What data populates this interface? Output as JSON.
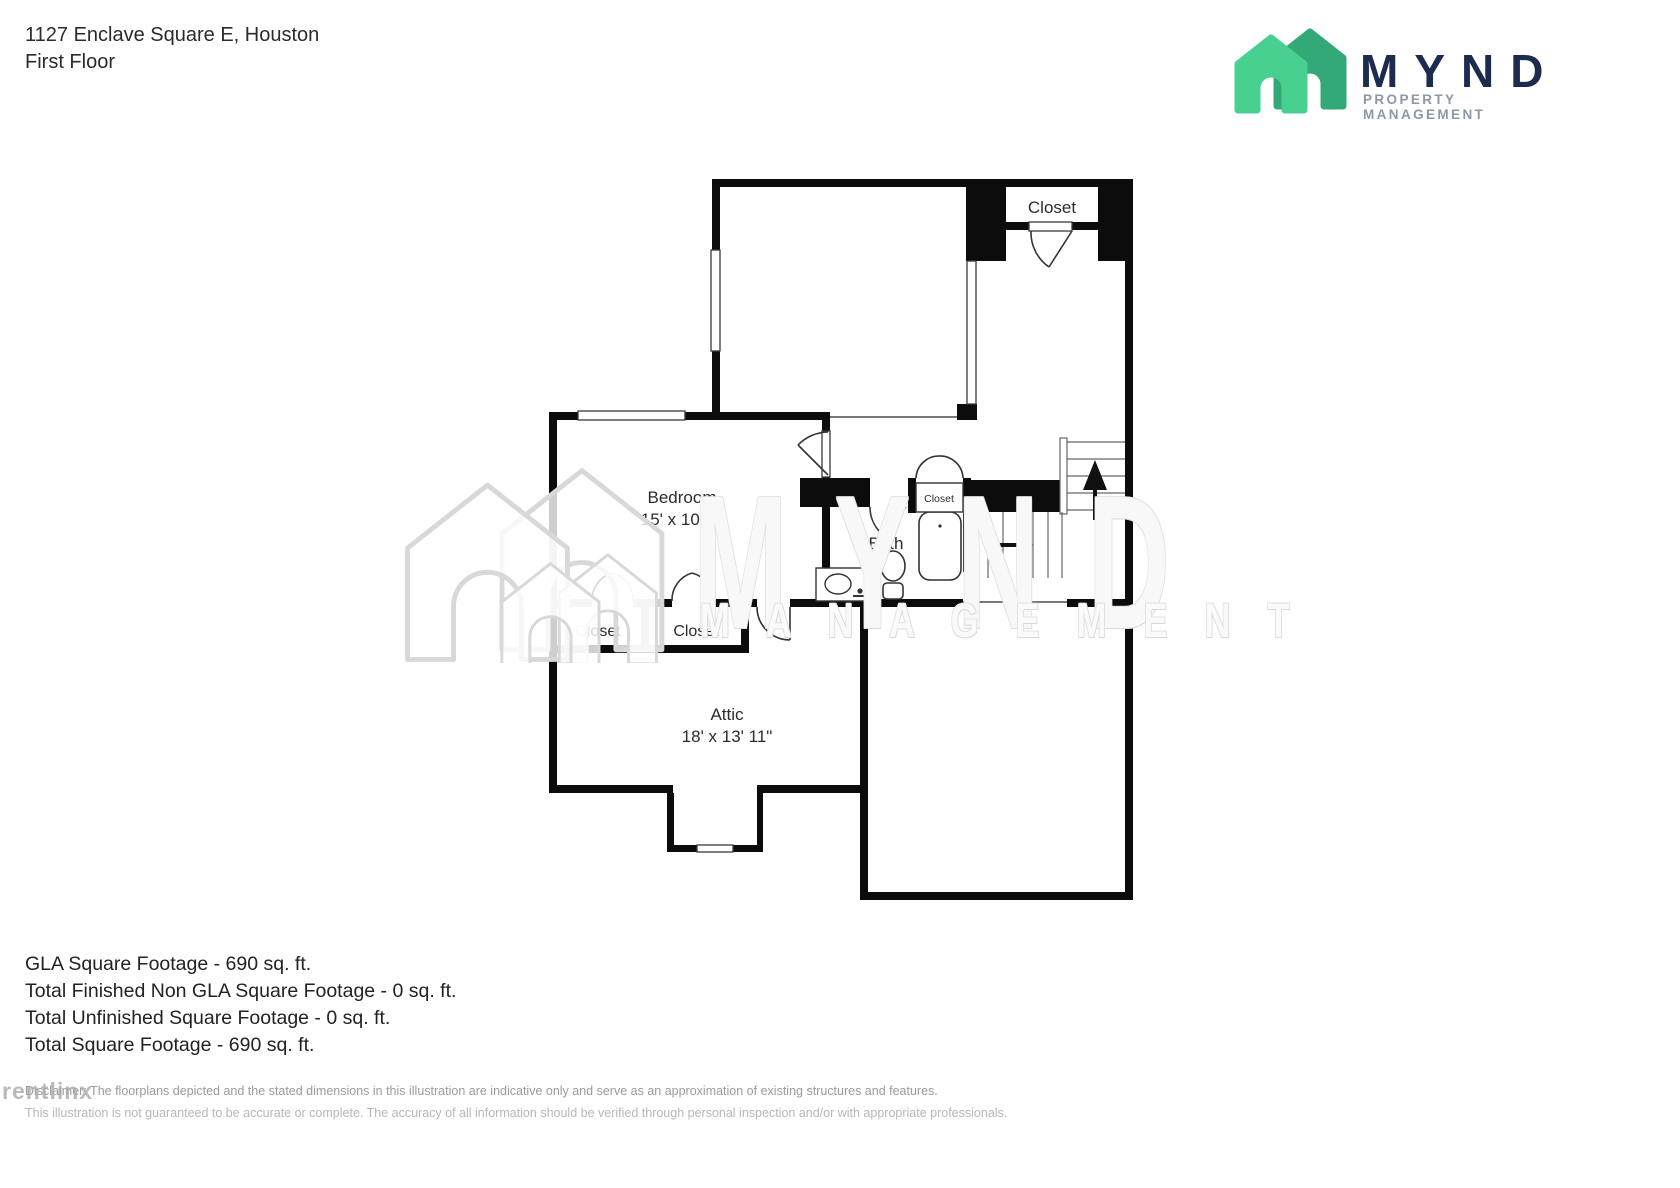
{
  "header": {
    "address": "1127 Enclave Square E, Houston",
    "floor": "First Floor"
  },
  "logo": {
    "name": "MYND",
    "subtitle": "PROPERTY MANAGEMENT",
    "colors": {
      "house_light": "#47d08f",
      "house_dark": "#33a977",
      "navy": "#1c2b4e",
      "gray": "#8d97a7"
    }
  },
  "floorplan": {
    "rooms": {
      "closet_top": {
        "label": "Closet"
      },
      "bedroom": {
        "label": "Bedroom",
        "dims": "15' x 10' 1\""
      },
      "bath": {
        "label": "Bath"
      },
      "bath_closet": {
        "label": "Closet"
      },
      "closet_left": {
        "label": "Closet"
      },
      "closet_right": {
        "label": "Closet"
      },
      "attic": {
        "label": "Attic",
        "dims": "18' x 13' 11\""
      }
    },
    "icons": [
      "stairs-up-arrow",
      "stairs-right-arrow",
      "toilet",
      "sink",
      "bathtub",
      "door-arc",
      "window"
    ]
  },
  "watermark": {
    "brand_word": "M Y N D",
    "management_word": "M A N A G E M E N T",
    "rentlinx": "rentlinx"
  },
  "footer": {
    "lines": [
      "GLA Square Footage - 690 sq. ft.",
      "Total Finished Non GLA Square Footage - 0 sq. ft.",
      "Total Unfinished Square Footage - 0 sq. ft.",
      "Total Square Footage - 690 sq. ft."
    ]
  },
  "disclaimer": {
    "line1": "Disclaimer: The floorplans depicted and the stated dimensions in this illustration are indicative only and serve as an approximation of existing structures and features.",
    "line2": "This illustration is not guaranteed to be accurate or complete. The accuracy of all information should be verified through personal inspection and/or with appropriate professionals."
  }
}
